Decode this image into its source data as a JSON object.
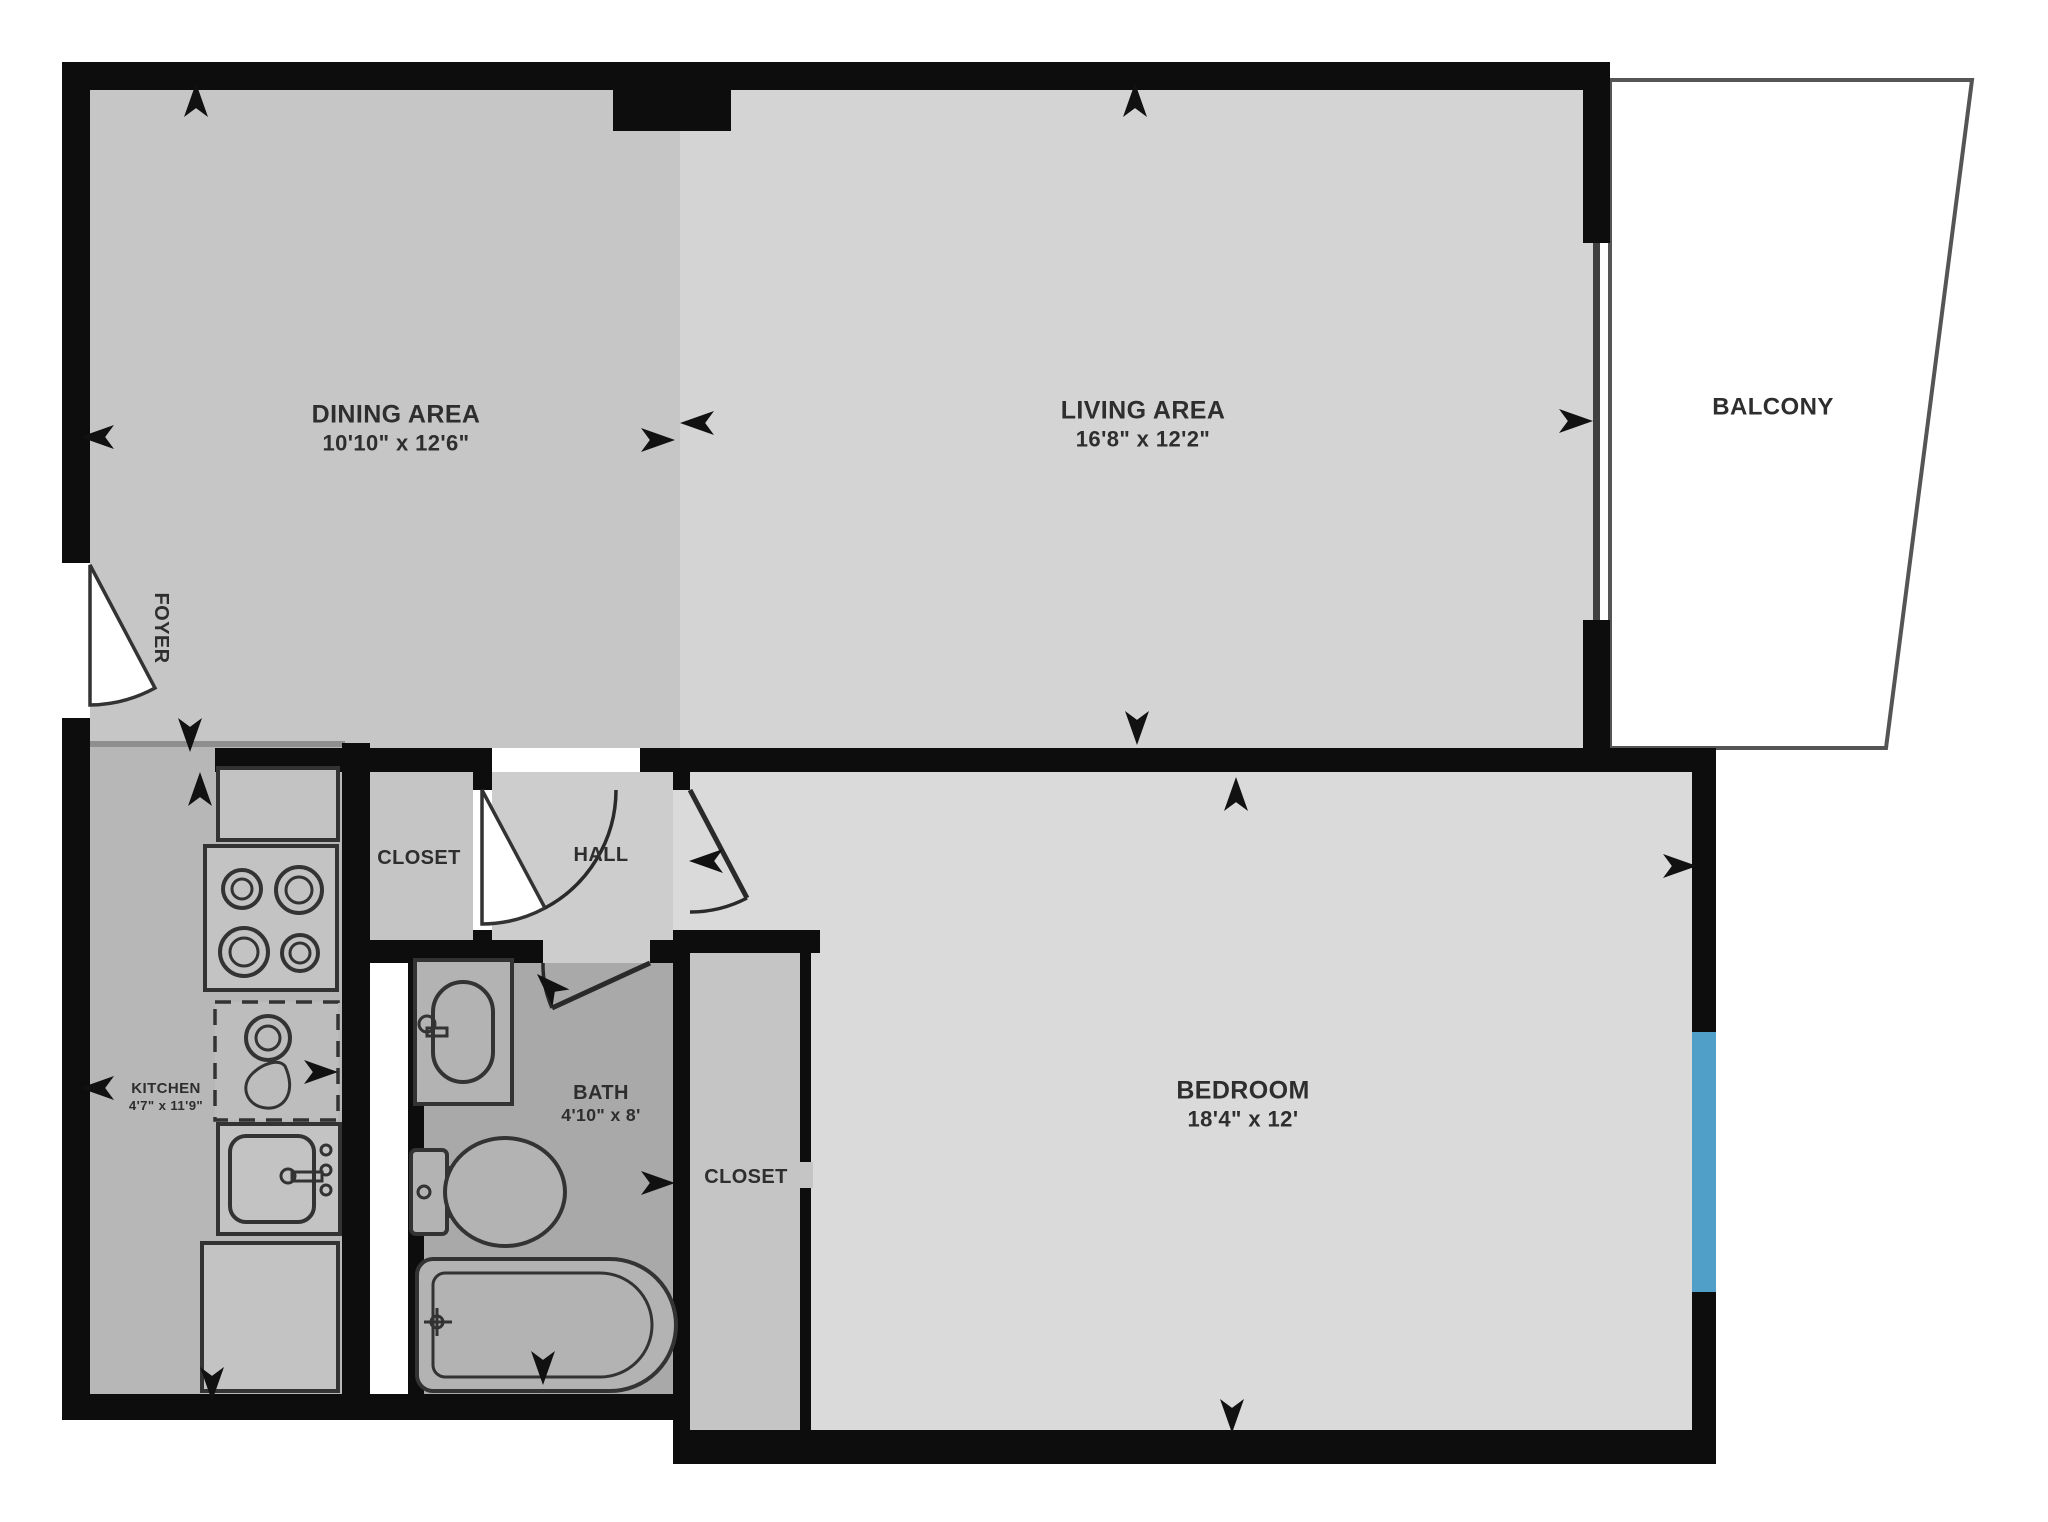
{
  "rooms": [
    {
      "name": "DINING AREA",
      "dims": "10'10\" x 12'6\""
    },
    {
      "name": "LIVING AREA",
      "dims": "16'8\" x 12'2\""
    },
    {
      "name": "BALCONY",
      "dims": ""
    },
    {
      "name": "FOYER",
      "dims": ""
    },
    {
      "name": "KITCHEN",
      "dims": "4'7\" x 11'9\""
    },
    {
      "name": "CLOSET",
      "dims": ""
    },
    {
      "name": "HALL",
      "dims": ""
    },
    {
      "name": "BATH",
      "dims": "4'10\" x 8'"
    },
    {
      "name": "CLOSET",
      "dims": ""
    },
    {
      "name": "BEDROOM",
      "dims": "18'4\" x 12'"
    }
  ],
  "colors": {
    "wall": "#0d0d0d",
    "arrow": "#111111",
    "text": "#2e2e2e",
    "floor_dining": "#c6c6c6",
    "floor_living": "#d4d4d4",
    "floor_kitchen": "#b7b7b7",
    "floor_hall": "#cdcdcd",
    "floor_bath": "#a9a9a9",
    "floor_bedroom": "#dadada",
    "floor_closet": "#c5c5c5",
    "balcony_floor": "#ffffff",
    "balcony_outline": "#555555",
    "window_accent": "#4f9fc8"
  },
  "fixtures": [
    "upper-counter",
    "stove",
    "dishwasher",
    "kitchen-sink",
    "lower-counter",
    "bath-vanity",
    "toilet",
    "bathtub"
  ],
  "doors": [
    "entry-door",
    "closet-door",
    "bedroom-door",
    "bath-door"
  ],
  "windows": [
    "living-window",
    "bedroom-window"
  ]
}
